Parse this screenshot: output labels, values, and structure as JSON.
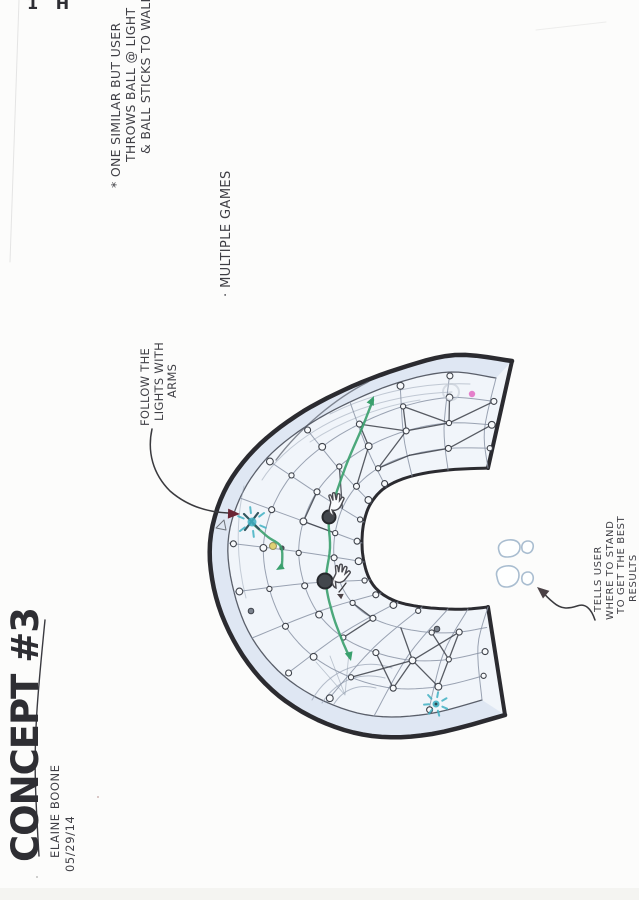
{
  "page": {
    "background": "#fcfcfb",
    "ink": "#3f3f45",
    "margin_mark": "1 H"
  },
  "title_block": {
    "title": "CONCEPT #3",
    "author": "ELAINE BOONE",
    "date": "05/29/14"
  },
  "annotations": {
    "side_note": {
      "lines": [
        "* ONE SIMILAR BUT USER",
        "THROWS BALL @ LIGHT",
        "& BALL STICKS TO WALL"
      ]
    },
    "bullet_note": "· MULTIPLE GAMES",
    "follow_label": {
      "lines": [
        "FOLLOW THE",
        "LIGHTS WITH",
        "ARMS"
      ]
    },
    "stand_label": {
      "lines": [
        "TELLS USER",
        "WHERE TO STAND",
        "TO GET THE BEST",
        "RESULTS"
      ]
    }
  },
  "sketch": {
    "colors": {
      "outline": "#2b2b30",
      "rim_line": "#5a5f6a",
      "grid": "#8a93a5",
      "constellation": "#3c4048",
      "wall_fill": "#f1f5fa",
      "rim_fill": "#dde6f2",
      "shade": "#98a3b3",
      "light_path_green": "#3aa06d",
      "starburst_teal": "#3fb0c2",
      "special_dot_pink": "#e273c5",
      "special_dot_yellow": "#ded173",
      "arrow_red": "#6b2433",
      "arrow_dark": "#4a4145",
      "footprint": "#a9bdd0",
      "dot_fill": "#f8fafc",
      "ball_fill": "#43474d"
    }
  }
}
